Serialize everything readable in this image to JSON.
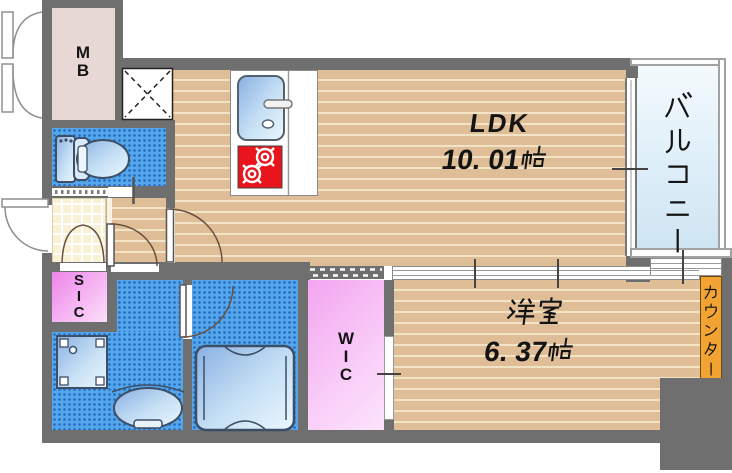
{
  "plan": {
    "rooms": {
      "ldk": {
        "label": "LDK",
        "size": "10. 01帖"
      },
      "western": {
        "label": "洋室",
        "size": "6. 37帖"
      },
      "balcony": {
        "label": "バルコニー"
      },
      "counter": {
        "label": "カウンター"
      },
      "meter_box": {
        "label": "MB"
      },
      "shoe_closet": {
        "label": "SIC"
      },
      "walk_in_closet": {
        "label": "WIC"
      }
    },
    "colors": {
      "wall": "#6f6f6f",
      "wood": "#dfbd96",
      "wet": "#55a7ec",
      "tile": "#f8f1d3",
      "mb": "#e7d8d6",
      "closet_pink": "#f2a4ef",
      "counter_orange": "#f2a332",
      "stove_red": "#e8151c",
      "balcony_blue": "#ddeef8"
    }
  }
}
